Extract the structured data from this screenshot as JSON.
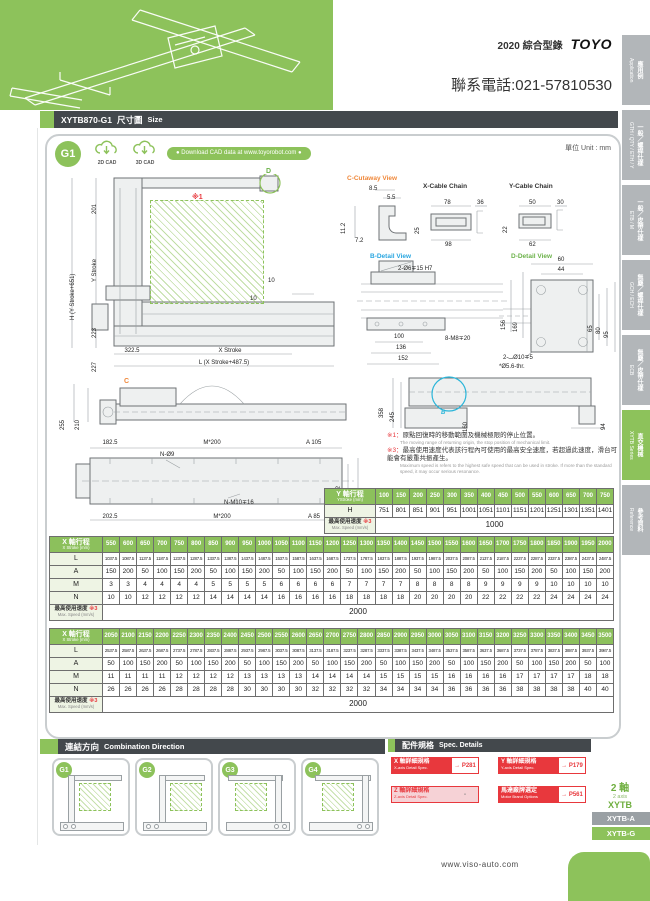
{
  "page": {
    "catalog_title": "2020 綜合型錄",
    "brand": "TOYO",
    "phone": "聯系電話:021-57810530",
    "unit_label": "單位 Unit : mm",
    "footer_url": "www.viso-auto.com",
    "colors": {
      "accent": "#8dc25b",
      "bar": "#43484c",
      "red": "#e8383d",
      "sidebar": "#b2b6b9"
    }
  },
  "header": {
    "model": "XYTB870-G1",
    "title_zh": "尺寸圖",
    "title_en": "Size"
  },
  "sidebar": {
    "tabs": [
      {
        "zh": "應用例",
        "en": "Application",
        "active": false
      },
      {
        "zh": "一般／螺桿仕樣",
        "en": "GTH / QTY / ETH / Y",
        "active": false
      },
      {
        "zh": "一般／皮帶仕樣",
        "en": "ETB / M",
        "active": false
      },
      {
        "zh": "無塵／螺桿仕樣",
        "en": "GCH / ECH",
        "active": false
      },
      {
        "zh": "無塵／皮帶仕樣",
        "en": "ECB",
        "active": false
      },
      {
        "zh": "直交機械",
        "en": "XYTB Series",
        "active": true
      },
      {
        "zh": "參考資料",
        "en": "Reference",
        "active": false
      }
    ]
  },
  "cad": {
    "badge": "G1",
    "cad2d": "2D CAD",
    "cad3d": "3D CAD",
    "download": "● Download CAD data at www.toyorobot.com ●"
  },
  "drawings": {
    "front": {
      "d_label": "D",
      "note_ref": "※1",
      "dim_201": "201",
      "dim_ystroke": "Y Stroke",
      "dim_223": "223",
      "dim_227": "227",
      "dim_h": "H (Y Stroke+651)",
      "dim_3225": "322.5",
      "dim_xstroke": "X Stroke",
      "dim_l": "L (X Stroke+487.5)",
      "dim_10a": "10",
      "dim_10b": "10"
    },
    "cutaway": {
      "title": "C-Cutaway View",
      "dim_85": "8.5",
      "dim_55": "5.5",
      "dim_112": "11.2",
      "dim_72": "7.2"
    },
    "xchain": {
      "title": "X-Cable Chain",
      "top": "78",
      "right": "36",
      "left": "25",
      "bottom": "98"
    },
    "ychain": {
      "title": "Y-Cable Chain",
      "top": "50",
      "right": "30",
      "left": "22",
      "bottom": "62"
    },
    "bdetail": {
      "title": "B-Detail View",
      "callout_top": "2-Ø6∓15 H7",
      "dim_156": "156",
      "dim_169": "169",
      "dim_100": "100",
      "dim_136": "136",
      "dim_152": "152",
      "callout_bottom": "8-M8∓20"
    },
    "ddetail": {
      "title": "D-Detail View",
      "dim_60": "60",
      "dim_44": "44",
      "dim_65": "65",
      "dim_80": "80",
      "dim_95": "95",
      "callout1": "2-⌴Ø10∓5",
      "callout2": "*Ø5.6-thr."
    },
    "side": {
      "c_label": "C",
      "dim_255": "255",
      "dim_210": "210"
    },
    "plan": {
      "dim_1825": "182.5",
      "dim_m200_top": "M*200",
      "dim_a105": "A 105",
      "callout_n9": "N-Ø9",
      "dim_182": "182",
      "dim_220": "220",
      "callout_nm10": "N-M10∓16",
      "dim_2025": "202.5",
      "dim_m200_bottom": "M*200",
      "dim_a85": "A 85"
    },
    "bview": {
      "b_label": "B",
      "dim_358": "358",
      "dim_245": "245",
      "dim_160": "160",
      "dim_94": "94"
    }
  },
  "notes": {
    "n1_ref": "※1：",
    "n1_zh": "原點回復時的移動範圍及機械極限的停止位置。",
    "n1_en": "The moving range of returning origin, the stop position of mechanical limit.",
    "n3_ref": "※3：",
    "n3_zh": "最高使用速度代表該行程內可使用的最高安全速度，若超過此速度，滑台可能會有嚴重共振產生。",
    "n3_en": "Maximum speed is refers to the highest safe speed that can be used in stroke. If more than the standard speed, it may occur serious resonance."
  },
  "y_table": {
    "label_zh": "Y 軸行程",
    "label_sub": "YStroke (mm)",
    "strokes": [
      "100",
      "150",
      "200",
      "250",
      "300",
      "350",
      "400",
      "450",
      "500",
      "550",
      "600",
      "650",
      "700",
      "750"
    ],
    "rows": [
      {
        "label": "H",
        "values": [
          "751",
          "801",
          "851",
          "901",
          "951",
          "1001",
          "1051",
          "1101",
          "1151",
          "1201",
          "1251",
          "1301",
          "1351",
          "1401"
        ]
      }
    ],
    "speed": {
      "zh": "最高使用速度",
      "ref": "※3",
      "sub": "Max. Speed (mm/s)",
      "value": "1000"
    }
  },
  "x_table_1": {
    "label_zh": "X 軸行程",
    "label_sub": "X Stroke (mm)",
    "strokes": [
      "550",
      "600",
      "650",
      "700",
      "750",
      "800",
      "850",
      "900",
      "950",
      "1000",
      "1050",
      "1100",
      "1150",
      "1200",
      "1250",
      "1300",
      "1350",
      "1400",
      "1450",
      "1500",
      "1550",
      "1600",
      "1650",
      "1700",
      "1750",
      "1800",
      "1850",
      "1900",
      "1950",
      "2000"
    ],
    "rows": [
      {
        "label": "L",
        "cls": "tiny",
        "values": [
          "1037.5",
          "1087.5",
          "1137.5",
          "1187.5",
          "1237.5",
          "1287.5",
          "1337.5",
          "1387.5",
          "1437.5",
          "1487.5",
          "1537.5",
          "1587.5",
          "1637.5",
          "1687.5",
          "1737.5",
          "1787.5",
          "1837.5",
          "1887.5",
          "1937.5",
          "1987.5",
          "2037.5",
          "2087.5",
          "2137.5",
          "2187.5",
          "2237.5",
          "2287.5",
          "2337.5",
          "2387.5",
          "2437.5",
          "2487.5"
        ]
      },
      {
        "label": "A",
        "values": [
          "150",
          "200",
          "50",
          "100",
          "150",
          "200",
          "50",
          "100",
          "150",
          "200",
          "50",
          "100",
          "150",
          "200",
          "50",
          "100",
          "150",
          "200",
          "50",
          "100",
          "150",
          "200",
          "50",
          "100",
          "150",
          "200",
          "50",
          "100",
          "150",
          "200"
        ]
      },
      {
        "label": "M",
        "values": [
          "3",
          "3",
          "4",
          "4",
          "4",
          "4",
          "5",
          "5",
          "5",
          "5",
          "6",
          "6",
          "6",
          "6",
          "7",
          "7",
          "7",
          "7",
          "8",
          "8",
          "8",
          "8",
          "9",
          "9",
          "9",
          "9",
          "10",
          "10",
          "10",
          "10"
        ]
      },
      {
        "label": "N",
        "values": [
          "10",
          "10",
          "12",
          "12",
          "12",
          "12",
          "14",
          "14",
          "14",
          "14",
          "16",
          "16",
          "16",
          "16",
          "18",
          "18",
          "18",
          "18",
          "20",
          "20",
          "20",
          "20",
          "22",
          "22",
          "22",
          "22",
          "24",
          "24",
          "24",
          "24"
        ]
      }
    ],
    "speed": {
      "zh": "最高使用速度",
      "ref": "※3",
      "sub": "Max. Speed (mm/s)",
      "value": "2000"
    }
  },
  "x_table_2": {
    "label_zh": "X 軸行程",
    "label_sub": "X Stroke (mm)",
    "strokes": [
      "2050",
      "2100",
      "2150",
      "2200",
      "2250",
      "2300",
      "2350",
      "2400",
      "2450",
      "2500",
      "2550",
      "2600",
      "2650",
      "2700",
      "2750",
      "2800",
      "2850",
      "2900",
      "2950",
      "3000",
      "3050",
      "3100",
      "3150",
      "3200",
      "3250",
      "3300",
      "3350",
      "3400",
      "3450",
      "3500"
    ],
    "rows": [
      {
        "label": "L",
        "cls": "tiny",
        "values": [
          "2537.5",
          "2587.5",
          "2637.5",
          "2687.5",
          "2737.5",
          "2787.5",
          "2837.5",
          "2887.5",
          "2937.5",
          "2987.5",
          "3037.5",
          "3087.5",
          "3137.5",
          "3187.5",
          "3237.5",
          "3287.5",
          "3337.5",
          "3387.5",
          "3437.5",
          "3487.5",
          "3537.5",
          "3587.5",
          "3637.5",
          "3687.5",
          "3737.5",
          "3787.5",
          "3837.5",
          "3887.5",
          "3937.5",
          "3987.5"
        ]
      },
      {
        "label": "A",
        "values": [
          "50",
          "100",
          "150",
          "200",
          "50",
          "100",
          "150",
          "200",
          "50",
          "100",
          "150",
          "200",
          "50",
          "100",
          "150",
          "200",
          "50",
          "100",
          "150",
          "200",
          "50",
          "100",
          "150",
          "200",
          "50",
          "100",
          "150",
          "200",
          "50",
          "100"
        ]
      },
      {
        "label": "M",
        "values": [
          "11",
          "11",
          "11",
          "11",
          "12",
          "12",
          "12",
          "12",
          "13",
          "13",
          "13",
          "13",
          "14",
          "14",
          "14",
          "14",
          "15",
          "15",
          "15",
          "15",
          "16",
          "16",
          "16",
          "16",
          "17",
          "17",
          "17",
          "17",
          "18",
          "18"
        ]
      },
      {
        "label": "N",
        "values": [
          "26",
          "26",
          "26",
          "26",
          "28",
          "28",
          "28",
          "28",
          "30",
          "30",
          "30",
          "30",
          "32",
          "32",
          "32",
          "32",
          "34",
          "34",
          "34",
          "34",
          "36",
          "36",
          "36",
          "36",
          "38",
          "38",
          "38",
          "38",
          "40",
          "40"
        ]
      }
    ],
    "speed": {
      "zh": "最高使用速度",
      "ref": "※3",
      "sub": "Max. Speed (mm/s)",
      "value": "2000"
    }
  },
  "combination": {
    "title_zh": "連結方向",
    "title_en": "Combination Direction",
    "items": [
      "G1",
      "G2",
      "G3",
      "G4"
    ]
  },
  "spec_details": {
    "title_zh": "配件規格",
    "title_en": "Spec. Details",
    "items": [
      {
        "zh": "X 軸詳細規格",
        "en": "X-axis Detail Spec.",
        "page": "→ P281",
        "muted": false
      },
      {
        "zh": "Y 軸詳細規格",
        "en": "Y-axis Detail Spec.",
        "page": "→ P179",
        "muted": false
      },
      {
        "zh": "Z 軸詳細規格",
        "en": "Z-axis Detail Spec.",
        "page": "-",
        "muted": true
      },
      {
        "zh": "馬達廠牌選定",
        "en": "Motor Brand Options",
        "page": "→ P561",
        "muted": false
      }
    ]
  },
  "series_box": {
    "axis_zh": "2 軸",
    "axis_en": "2 axis",
    "series": "XYTB",
    "tabs": [
      {
        "label": "XYTB-A",
        "active": false
      },
      {
        "label": "XYTB-G",
        "active": true
      }
    ]
  }
}
